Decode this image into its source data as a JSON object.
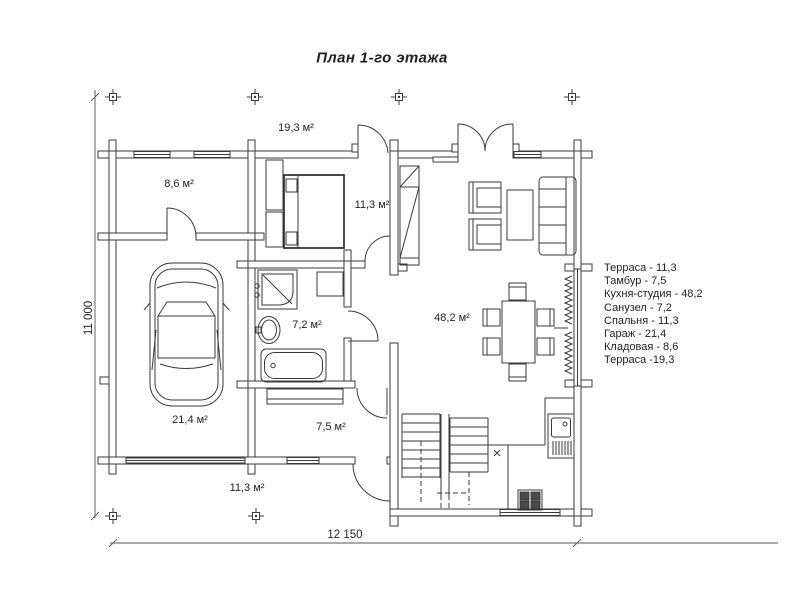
{
  "title": "План 1-го этажа",
  "colors": {
    "line": "#3a3a3a",
    "text": "#1f1f1f",
    "background": "#ffffff"
  },
  "rooms": [
    {
      "id": "terrace-top",
      "area_label": "19,3 м²"
    },
    {
      "id": "storeroom",
      "area_label": "8,6 м²"
    },
    {
      "id": "bedroom",
      "area_label": "11,3 м²"
    },
    {
      "id": "bathroom",
      "area_label": "7,2 м²"
    },
    {
      "id": "kitchen-studio",
      "area_label": "48,2 м²"
    },
    {
      "id": "garage",
      "area_label": "21,4 м²"
    },
    {
      "id": "entrance-hall",
      "area_label": "7,5 м²"
    },
    {
      "id": "terrace-bottom",
      "area_label": "11,3 м²"
    }
  ],
  "legend": {
    "items": [
      "Терраса - 11,3",
      "Тамбур - 7,5",
      "Кухня-студия - 48,2",
      "Санузел - 7,2",
      "Спальня - 11,3",
      "Гараж - 21,4",
      "Кладовая - 8,6",
      "Терраса  -19,3"
    ]
  },
  "dimensions": {
    "width": "12 150",
    "height": "11 000"
  }
}
